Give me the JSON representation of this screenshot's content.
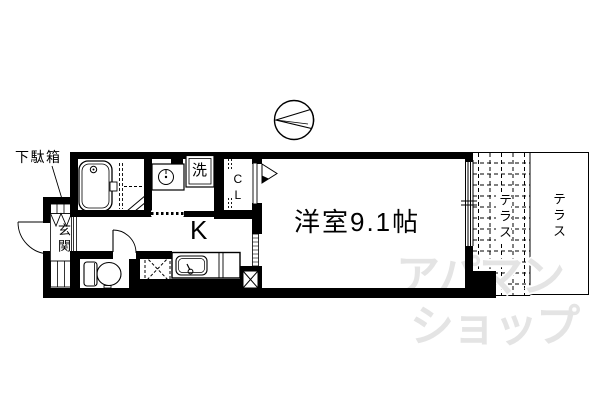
{
  "plan": {
    "labels": {
      "shoe_box": "下駄箱",
      "entrance": "玄関",
      "washer": "洗",
      "closet": "CL",
      "kitchen": "K",
      "main_room": "洋室9.1帖",
      "terrace_inner": "テラス",
      "terrace_outer": "テラス"
    },
    "watermark": {
      "line1": "アパマン",
      "line2": "ショップ"
    },
    "colors": {
      "line": "#000000",
      "watermark": "#e4e4e4",
      "background": "#ffffff"
    },
    "icons": {
      "compass": "north-arrow-in-circle"
    }
  }
}
